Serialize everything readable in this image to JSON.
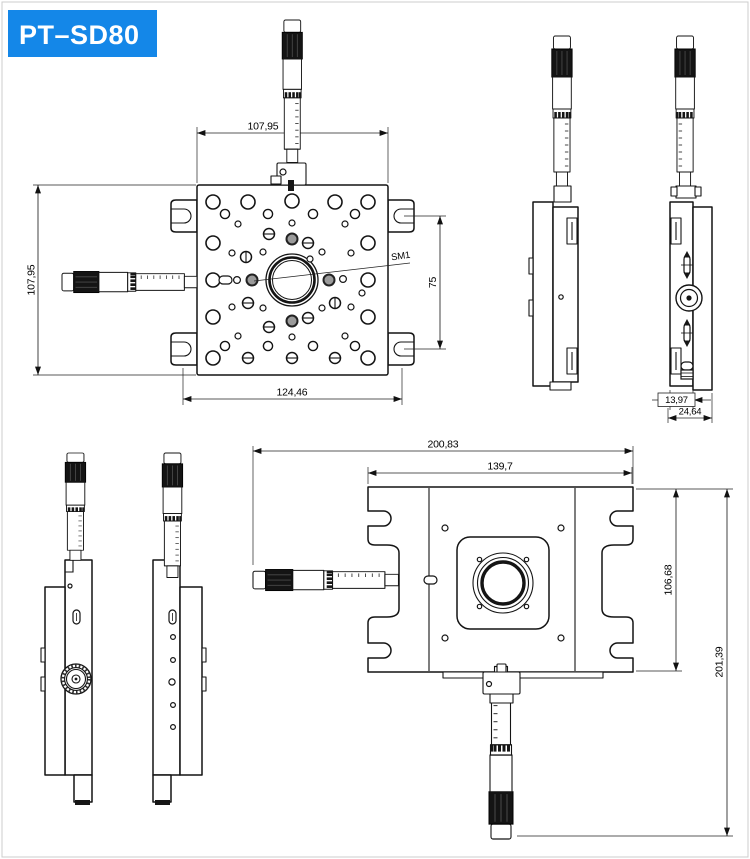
{
  "title_badge": {
    "label": "PT–SD80",
    "bg": "#1487e8",
    "fg": "#ffffff"
  },
  "drawing": {
    "line_color": "#141414",
    "views": {
      "top": {
        "name": "top view",
        "dims": {
          "width_top": "107,95",
          "height_left": "107,95",
          "width_bottom": "124,46",
          "slot_spacing_right": "75"
        },
        "labels": {
          "center_thread": "SM1"
        }
      },
      "side_right": {
        "name": "right side view",
        "dims": {
          "plate_thickness": "13,97",
          "overall_thickness": "24,64"
        }
      },
      "bottom": {
        "name": "bottom view",
        "dims": {
          "overall_width": "200,83",
          "body_width": "139,7",
          "body_height": "106,68",
          "overall_height": "201,39"
        }
      }
    }
  }
}
